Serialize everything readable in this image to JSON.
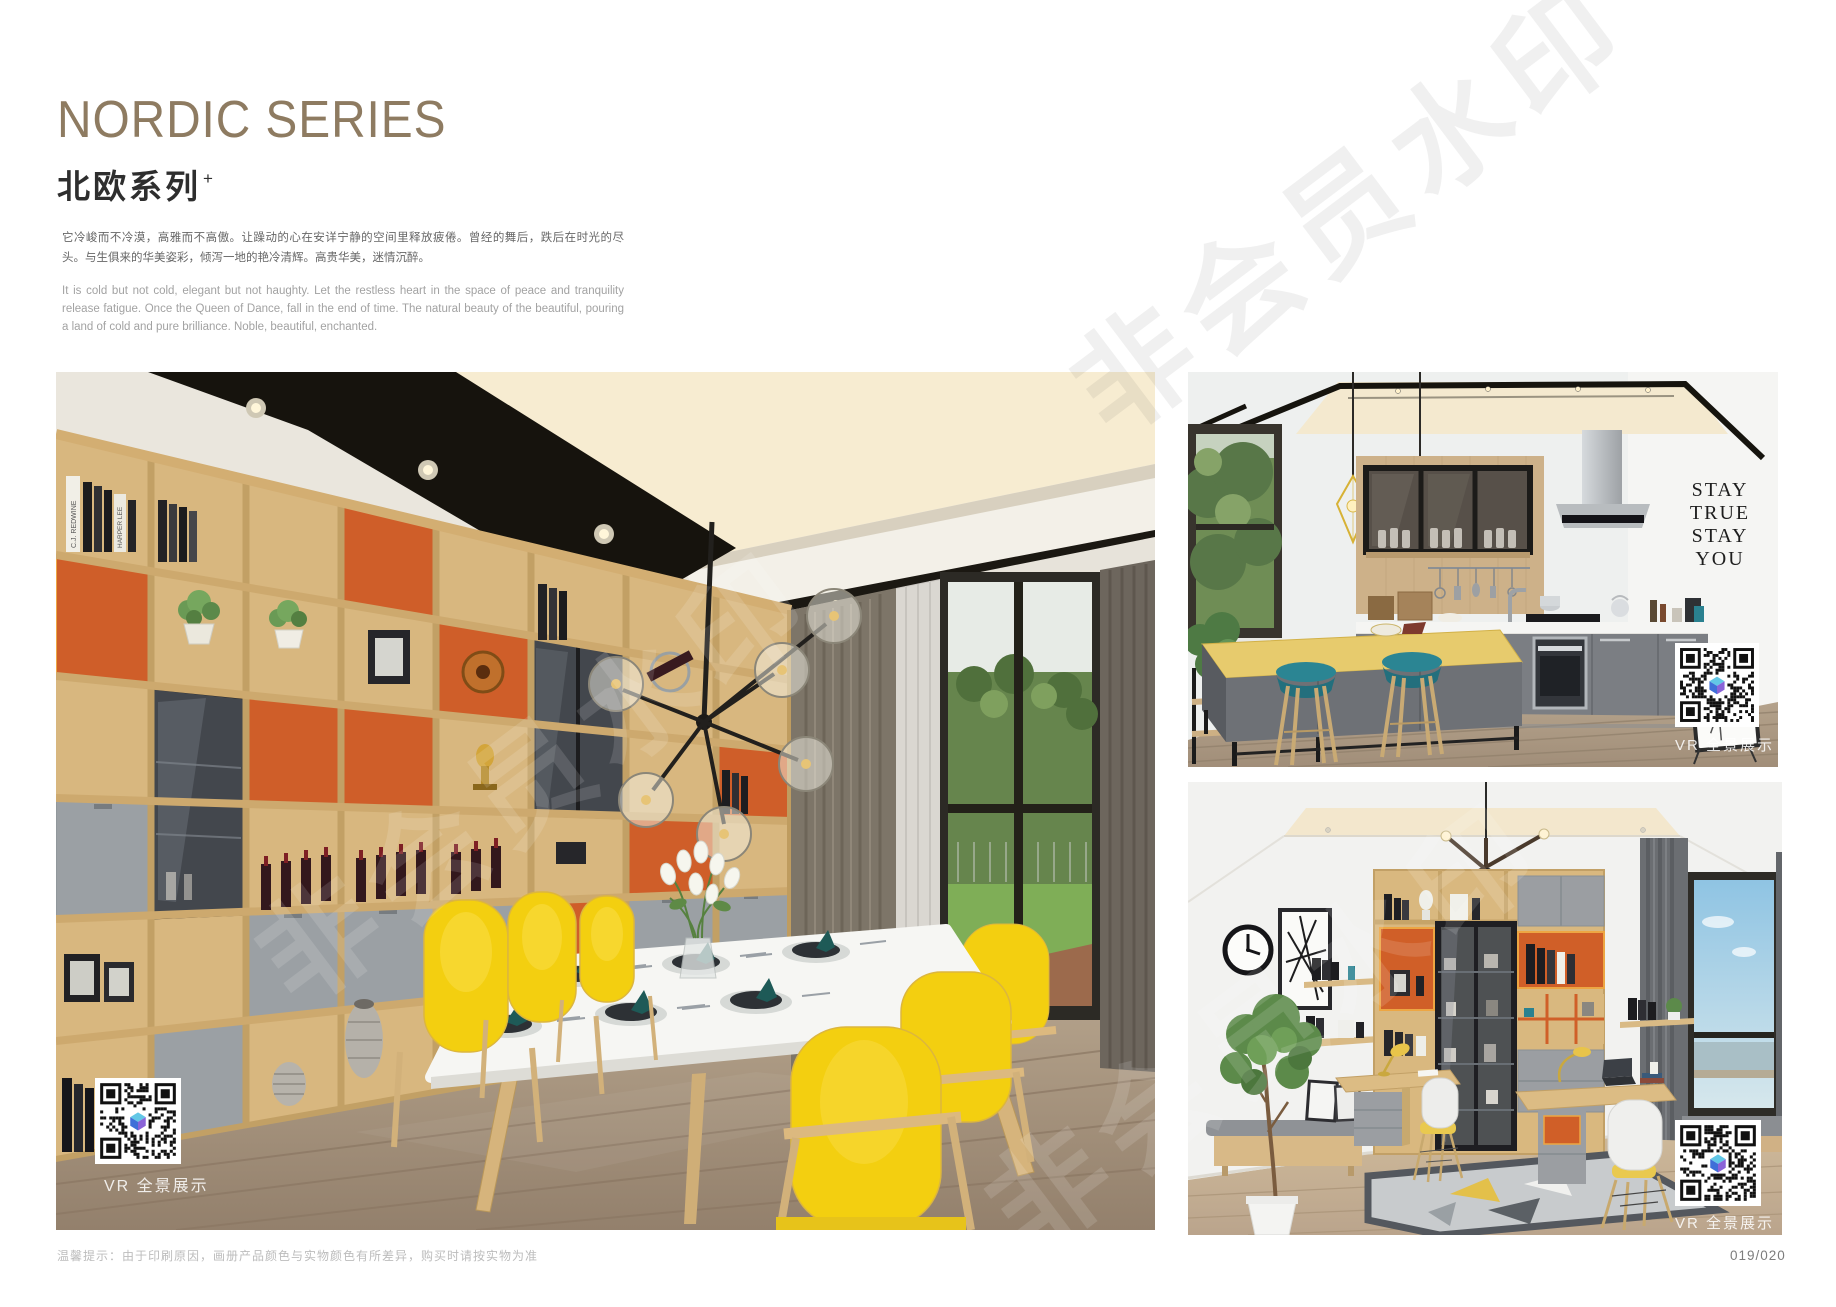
{
  "page": {
    "title_en": "NORDIC SERIES",
    "title_zh": "北欧系列",
    "title_sup": "+",
    "desc_zh": "它冷峻而不冷漠，高雅而不高傲。让躁动的心在安详宁静的空间里释放疲倦。曾经的舞后，跌后在时光的尽头。与生俱来的华美姿彩，倾泻一地的艳冷清辉。高贵华美，迷情沉醉。",
    "desc_en": "It is cold but not cold, elegant but not haughty. Let the restless heart in the space of peace and tranquility release fatigue. Once the Queen of Dance, fall in the end of time. The natural beauty of the beautiful, pouring a land of cold and pure brilliance. Noble, beautiful, enchanted.",
    "footer_note": "温馨提示：由于印刷原因，画册产品颜色与实物颜色有所差异，购买时请按实物为准",
    "page_number": "019/020"
  },
  "watermark": {
    "text": "非会员水印"
  },
  "photos": {
    "dining": {
      "vr_label": "VR 全景展示",
      "book_spines": [
        "C.J. REDWINE",
        "HARPER LEE"
      ]
    },
    "kitchen": {
      "vr_label": "VR 全景展示",
      "wall_art_lines": [
        "STAY",
        "TRUE",
        "STAY",
        "YOU"
      ]
    },
    "study": {
      "vr_label": "VR 全景展示"
    }
  },
  "colors": {
    "title": "#8e7b61",
    "accent_orange": "#cf5f28",
    "accent_yellow": "#f3d011",
    "accent_teal": "#27808e"
  }
}
